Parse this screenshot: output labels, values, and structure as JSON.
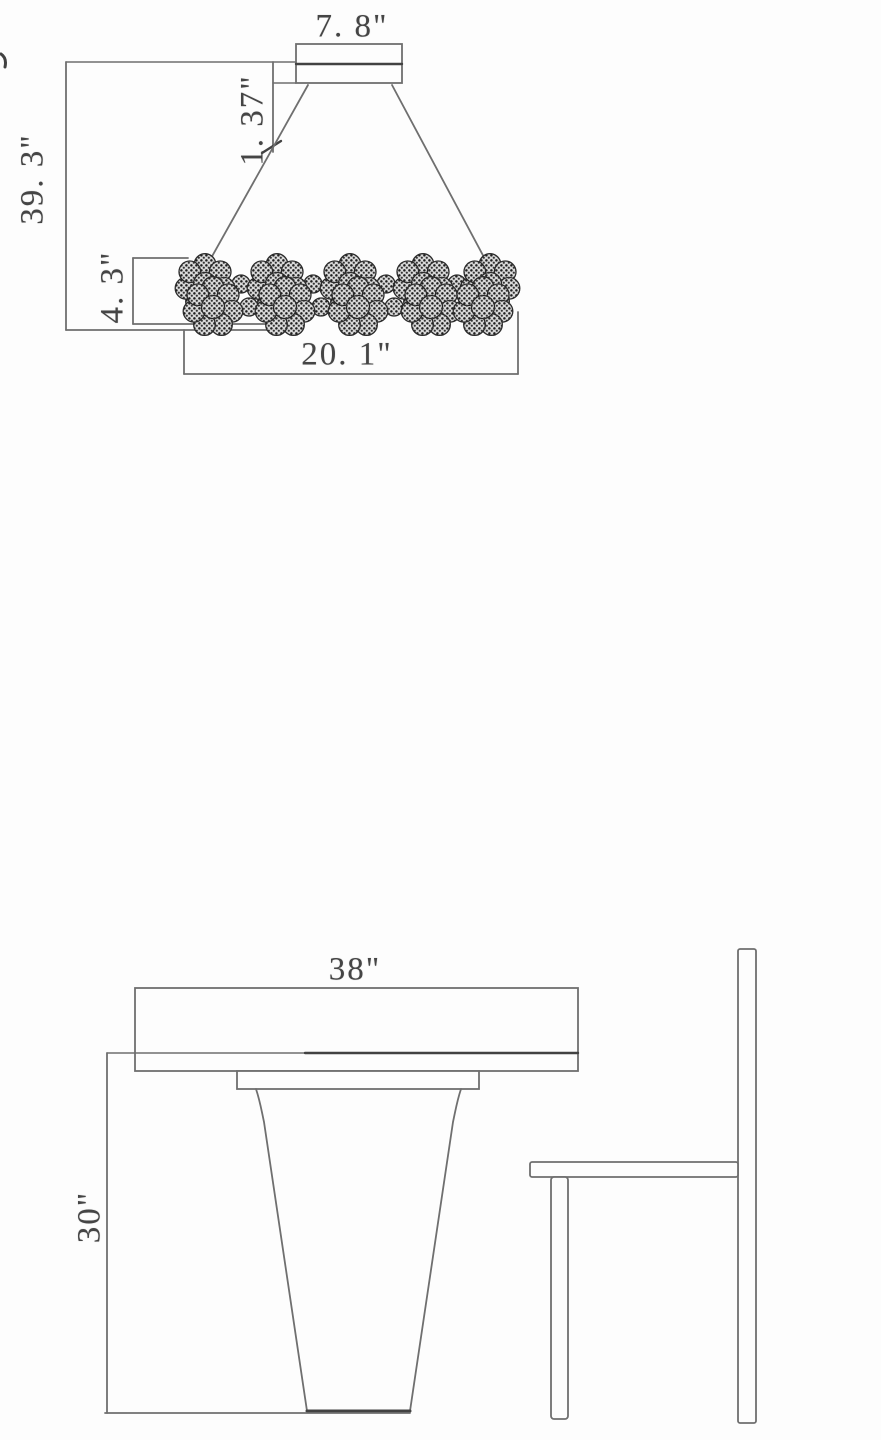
{
  "colors": {
    "background": "#fdfdfd",
    "line": "#6f6f6f",
    "line_dark": "#424242",
    "text": "#454545"
  },
  "chandelier_view": {
    "dimensions": {
      "canopy_width": "7. 8\"",
      "canopy_height": "1. 37\"",
      "overall_height": "39. 3\"",
      "fixture_height": "4. 3\"",
      "fixture_width": "20. 1\""
    }
  },
  "table_view": {
    "dimensions": {
      "tabletop_width": "38\"",
      "table_height": "30\""
    }
  }
}
